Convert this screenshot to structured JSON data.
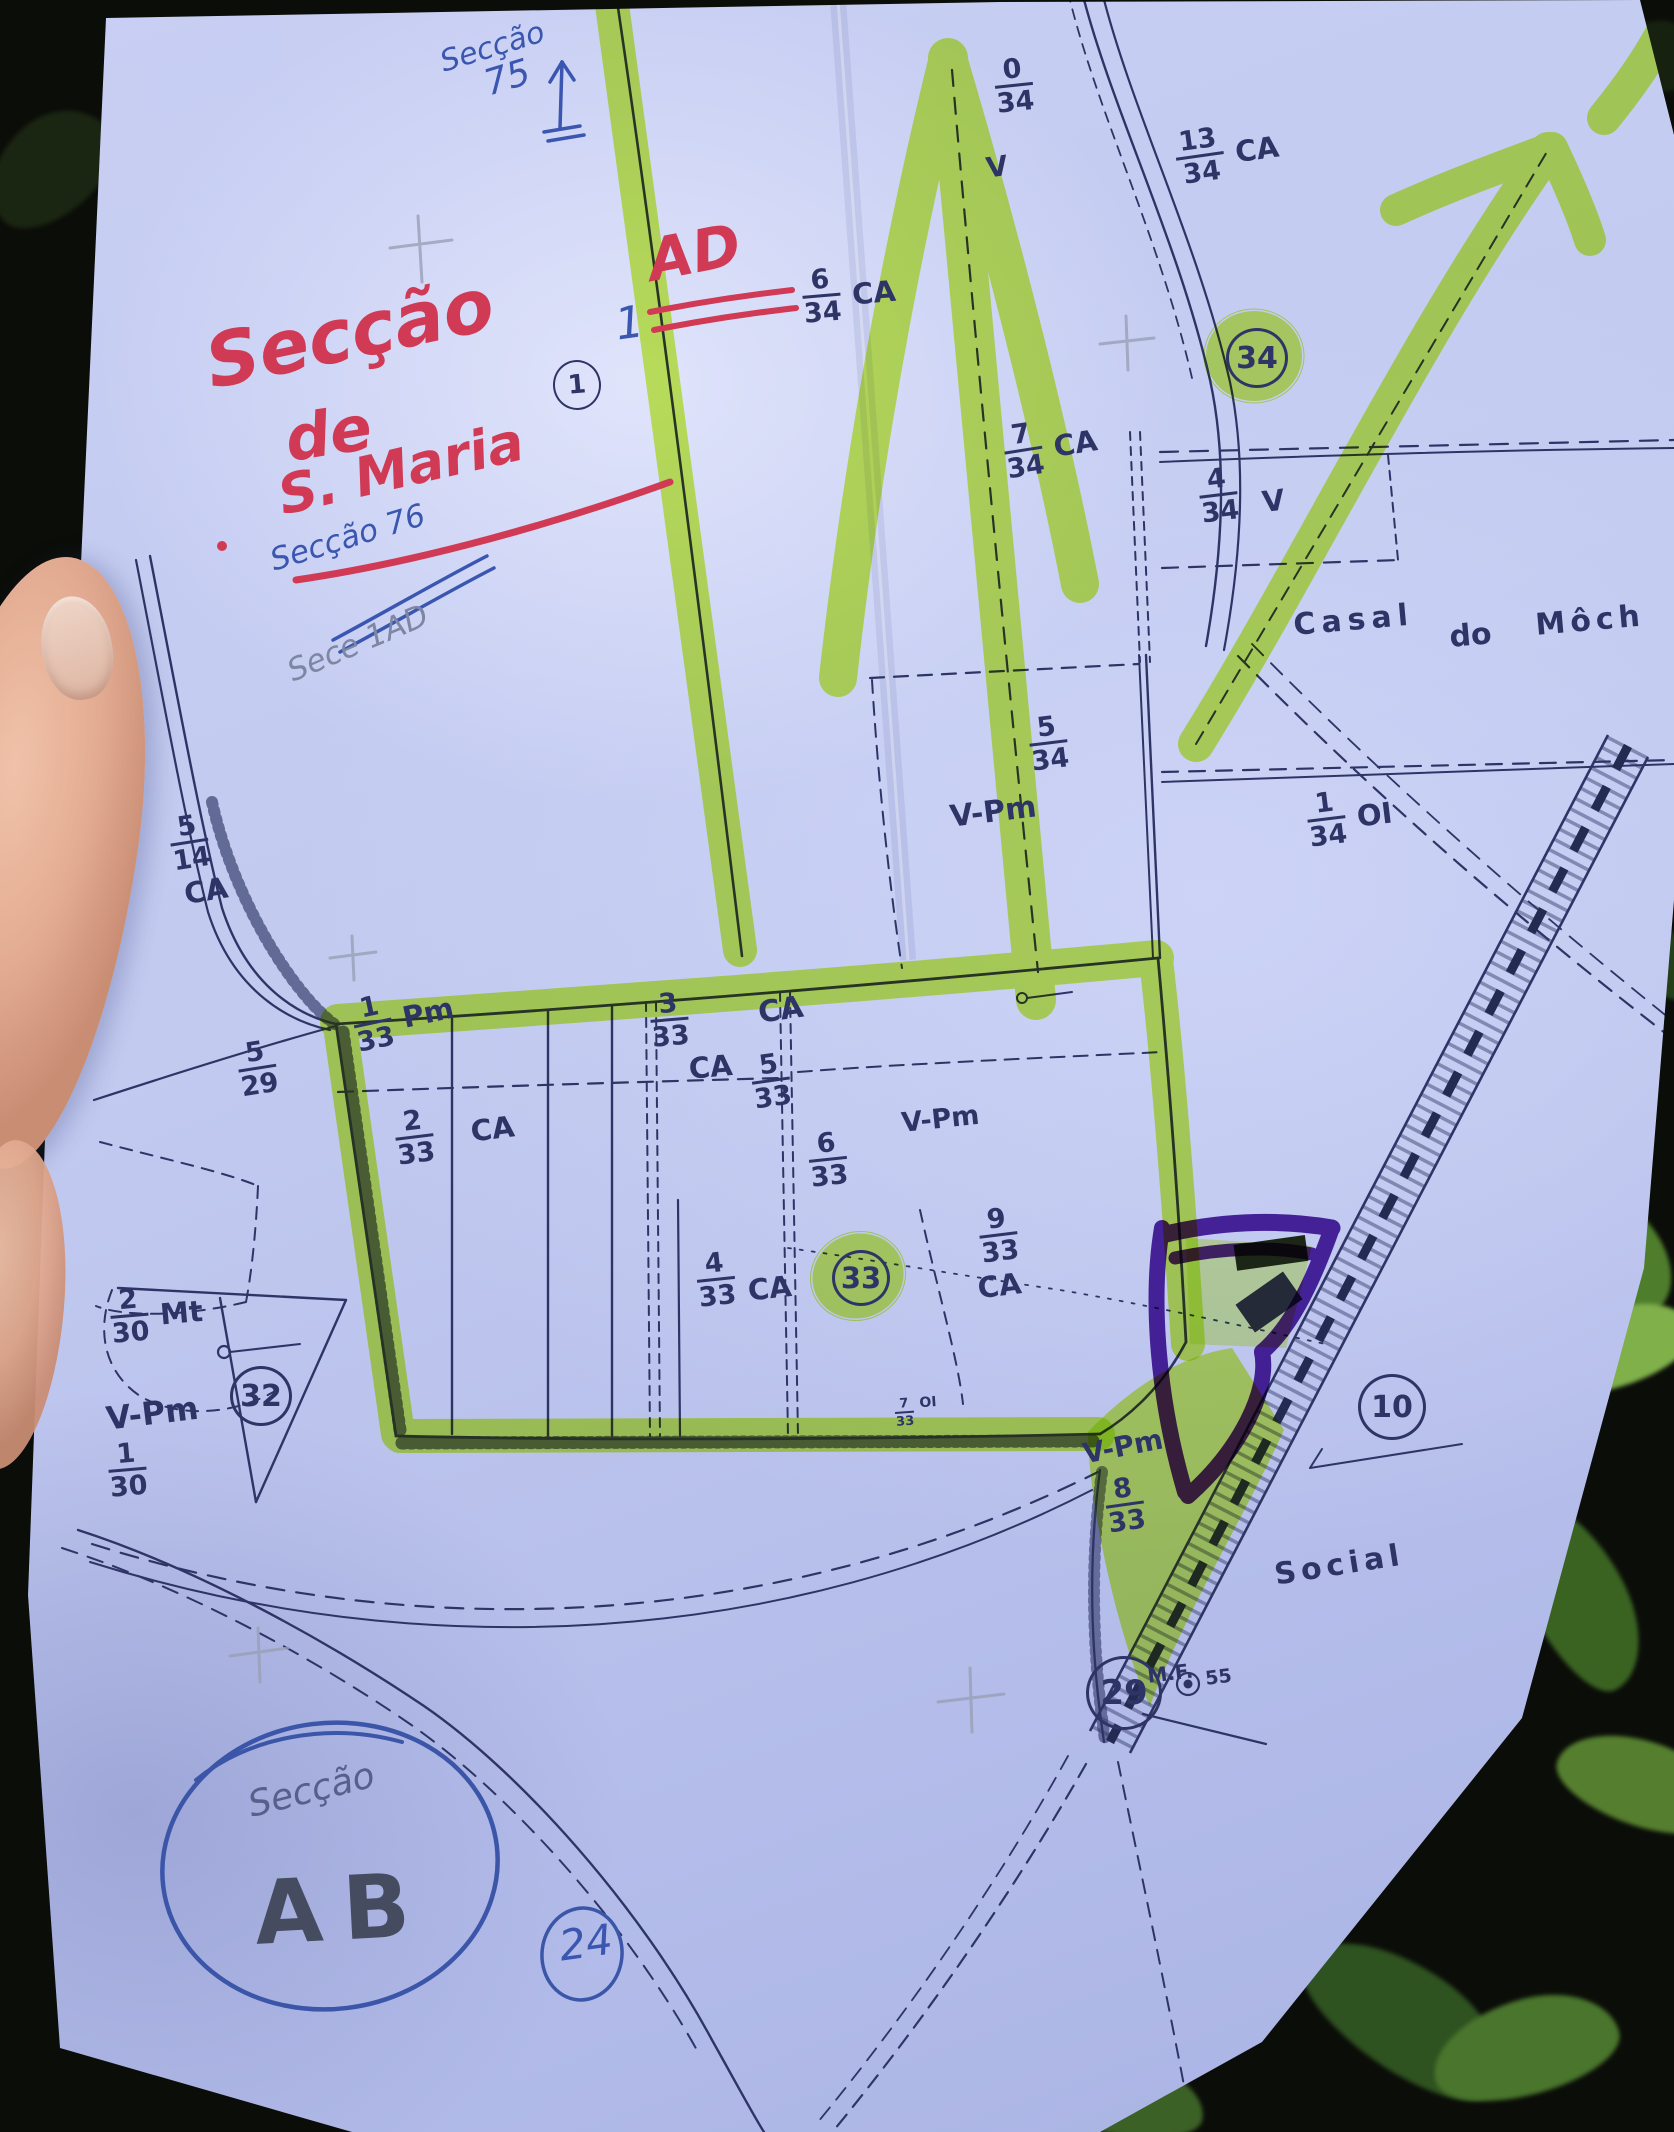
{
  "colors": {
    "highlighter": "#c9f43e",
    "purple_marker": "#4a1596",
    "red_pen": "#d13a55",
    "blue_pen": "#3a56b0",
    "map_ink": "#2e3566",
    "pencil": "#7d86a2",
    "paper": "#c7cff2"
  },
  "handwriting": {
    "blue_top_note_word": "Secção",
    "blue_top_note_num": "75",
    "red_title_word": "Secção",
    "blue_sup": "1",
    "red_title_code": "AD",
    "red_line2": "de",
    "red_line3": "S. Maria",
    "blue_mid_note": "Secção 76",
    "pencil_note": "Sece 1AD",
    "bottom_section_word": "Secção",
    "bottom_section_code": "AB",
    "bottom_circle_num": "24"
  },
  "map": {
    "circled": {
      "c1": "1",
      "c34": "34",
      "c33": "33",
      "c32": "32",
      "c29": "29",
      "c10": "10"
    },
    "region_labels": {
      "casal_1": "Casal",
      "casal_2": "do",
      "casal_3": "Môch",
      "social": "Social",
      "mf": "M.F.",
      "mf_num": "55"
    },
    "codes": {
      "v_top": "V",
      "ca_mid": "CA",
      "vpm_1": "V-Pm",
      "vpm_2": "V-Pm",
      "vpm_3": "V-Pm",
      "vpm_4": "V-Pm"
    },
    "parcels": [
      {
        "n": "0",
        "d": "34"
      },
      {
        "n": "6",
        "d": "34",
        "c": "CA"
      },
      {
        "n": "13",
        "d": "34",
        "c": "CA"
      },
      {
        "n": "7",
        "d": "34",
        "c": "CA"
      },
      {
        "n": "4",
        "d": "34",
        "c": "V"
      },
      {
        "n": "5",
        "d": "34"
      },
      {
        "n": "1",
        "d": "34",
        "c": "OI"
      },
      {
        "n": "5",
        "d": "14",
        "c": "CA"
      },
      {
        "n": "5",
        "d": "29"
      },
      {
        "n": "1",
        "d": "33",
        "c": "Pm"
      },
      {
        "n": "2",
        "d": "33",
        "c": "CA"
      },
      {
        "n": "3",
        "d": "33",
        "c": "CA"
      },
      {
        "n": "5",
        "d": "33"
      },
      {
        "n": "6",
        "d": "33"
      },
      {
        "n": "9",
        "d": "33",
        "c": "CA"
      },
      {
        "n": "4",
        "d": "33",
        "c": "CA"
      },
      {
        "n": "2",
        "d": "30",
        "c": "Mt"
      },
      {
        "n": "1",
        "d": "30"
      },
      {
        "n": "7",
        "d": "33",
        "c": "OI"
      },
      {
        "n": "8",
        "d": "33"
      }
    ]
  }
}
